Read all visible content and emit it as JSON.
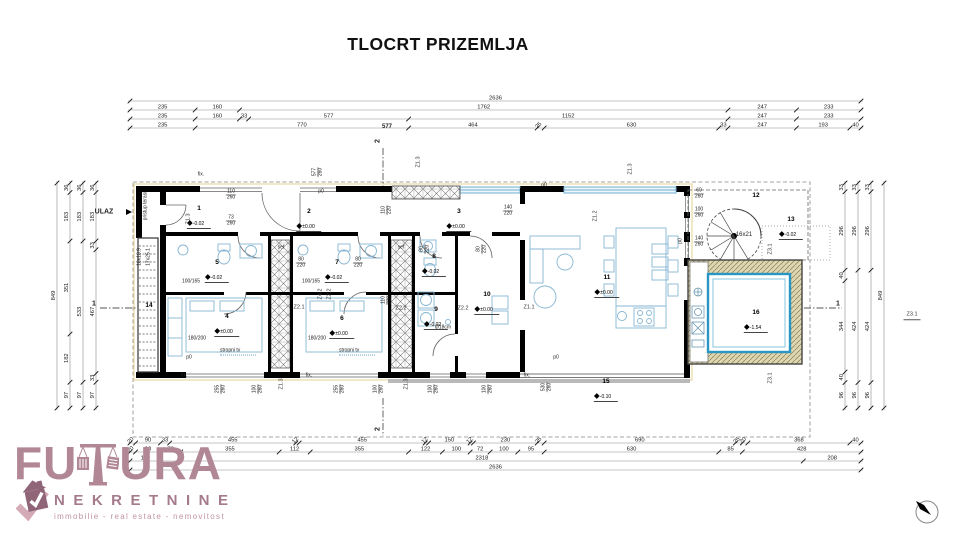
{
  "title": "TLOCRT PRIZEMLJA",
  "dimensions": {
    "top_rows": [
      [
        "2636"
      ],
      [
        "235",
        "160",
        "1762",
        "247",
        "233"
      ],
      [
        "235",
        "160",
        "33",
        "577",
        "1152",
        "247",
        "233"
      ],
      [
        "235",
        "770",
        "464",
        "25",
        "630",
        "33",
        "247",
        "193",
        "40"
      ]
    ],
    "bottom_rows": [
      [
        "20",
        "90",
        "33",
        "455",
        "12",
        "455",
        "12",
        "150",
        "12",
        "230",
        "25",
        "690",
        "25",
        "20",
        "368",
        "40"
      ],
      [
        "20",
        "90",
        "73",
        "355",
        "112",
        "355",
        "122",
        "100",
        "72",
        "100",
        "95",
        "630",
        "85",
        "428"
      ],
      [
        "110",
        "2318",
        "208"
      ],
      [
        "2636"
      ]
    ],
    "left_cols": [
      [
        "849"
      ],
      [
        "36",
        "183",
        "351",
        "182",
        "97"
      ],
      [
        "36",
        "183",
        "533",
        "97"
      ],
      [
        "36",
        "183",
        "33",
        "467",
        "33",
        "97"
      ]
    ],
    "right_cols": [
      [
        "33",
        "296",
        "40",
        "344",
        "40",
        "96"
      ],
      [
        "33",
        "296",
        "424",
        "96"
      ],
      [
        "33",
        "296",
        "424",
        "96"
      ],
      [
        "849"
      ]
    ],
    "overlay_bold": "577"
  },
  "rooms": [
    {
      "num": "1",
      "level": "-0.02"
    },
    {
      "num": "2",
      "level": "±0.00"
    },
    {
      "num": "3",
      "level": "±0.00"
    },
    {
      "num": "4",
      "level": "±0.00"
    },
    {
      "num": "5",
      "level": "-0.02"
    },
    {
      "num": "6",
      "level": "±0.00"
    },
    {
      "num": "7",
      "level": "-0.02"
    },
    {
      "num": "8",
      "level": "-0.02"
    },
    {
      "num": "9",
      "level": "-0.02"
    },
    {
      "num": "10",
      "level": "±0.00"
    },
    {
      "num": "11",
      "level": "±0.00"
    },
    {
      "num": "12",
      "level": ""
    },
    {
      "num": "13",
      "level": "-0.02"
    },
    {
      "num": "14",
      "level": ""
    },
    {
      "num": "15",
      "level": "-0.10"
    },
    {
      "num": "16",
      "level": "-1.54"
    }
  ],
  "labels": {
    "ulaz": "ULAZ",
    "pristup_terasi": "pristup terasi",
    "stair_spec_1": "18x18.9",
    "stair_spec_2": "17x25.1",
    "sef": "sef",
    "stropni_tv": "stropni tv",
    "bed_size": "180/200",
    "shower_size": "100/165",
    "drain": "Ø18cm",
    "spiral_steps": "16x21",
    "fix": "fix.",
    "p0": "p0",
    "section_1": "1",
    "section_2": "2",
    "zones": {
      "z11": "Z1.1",
      "z12": "Z1.2",
      "z13": "Z1.3",
      "z21": "Z2.1",
      "z22": "Z2.2",
      "z31": "Z3.1",
      "z42": "Z4.2"
    },
    "openings": {
      "o110_260": "110/260",
      "o73_260": "73/260",
      "o140_220": "140/220",
      "o80_220": "80/220",
      "o110_220": "110/220",
      "o100_260": "100/260",
      "o255_260": "255/260",
      "o530_260": "530/260",
      "o60_260": "60/260",
      "o140_260": "140/260",
      "o577_260": "577/260"
    }
  },
  "logo": {
    "word_part1": "FU",
    "word_part2": "URA",
    "word_bottom": "NEKRETNINE",
    "tagline": "immobilie - real estate - nemovitost",
    "color_main": "#b18795",
    "color_dark": "#8f6577",
    "color_light": "#c9a0ae"
  }
}
